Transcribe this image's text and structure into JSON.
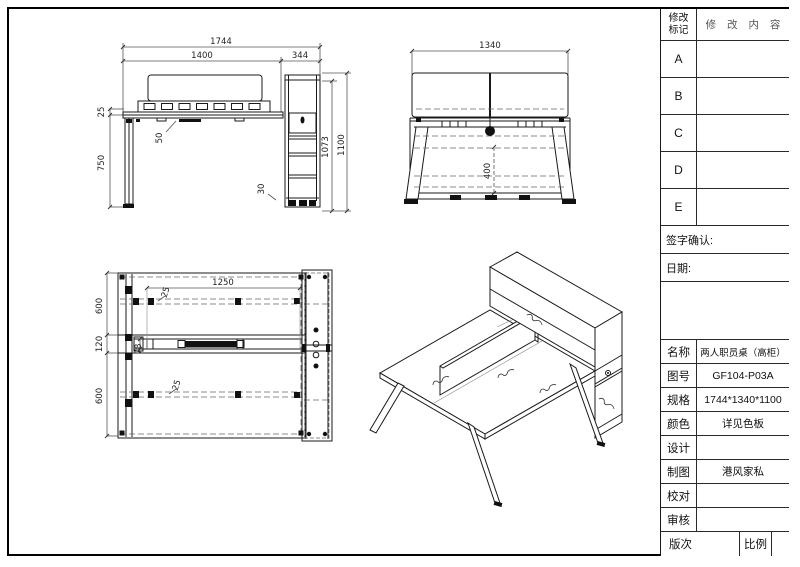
{
  "sheet": {
    "revision": {
      "mark_label_line1": "修改",
      "mark_label_line2": "标记",
      "content_label": "修 改 内 容",
      "rows": [
        "A",
        "B",
        "C",
        "D",
        "E"
      ]
    },
    "sign_confirm_label": "签字确认:",
    "date_label": "日期:",
    "fields": [
      {
        "label": "名称",
        "value": "两人职员桌（高柜）"
      },
      {
        "label": "图号",
        "value": "GF104-P03A"
      },
      {
        "label": "规格",
        "value": "1744*1340*1100"
      },
      {
        "label": "颜色",
        "value": "详见色板"
      },
      {
        "label": "设计",
        "value": ""
      },
      {
        "label": "制图",
        "value": "港风家私"
      },
      {
        "label": "校对",
        "value": ""
      },
      {
        "label": "审核",
        "value": ""
      }
    ],
    "footer": {
      "version_label": "版次",
      "scale_label": "比例"
    }
  },
  "views": {
    "front": {
      "dims": {
        "overall_width": "1744",
        "desk_width": "1400",
        "cabinet_width": "344",
        "top_thickness": "25",
        "leg_height": "750",
        "apron_drop": "50",
        "plinth_height": "30",
        "cabinet_height": "1073",
        "overall_height": "1100"
      }
    },
    "side": {
      "dims": {
        "overall_depth": "1340",
        "beam_clearance": "400"
      }
    },
    "plan": {
      "dims": {
        "worktop_length": "1250",
        "near_depth": "600",
        "center_band": "120",
        "far_depth": "600",
        "beam_width": "78",
        "offset_top": "25",
        "offset_bottom": "25"
      }
    }
  }
}
